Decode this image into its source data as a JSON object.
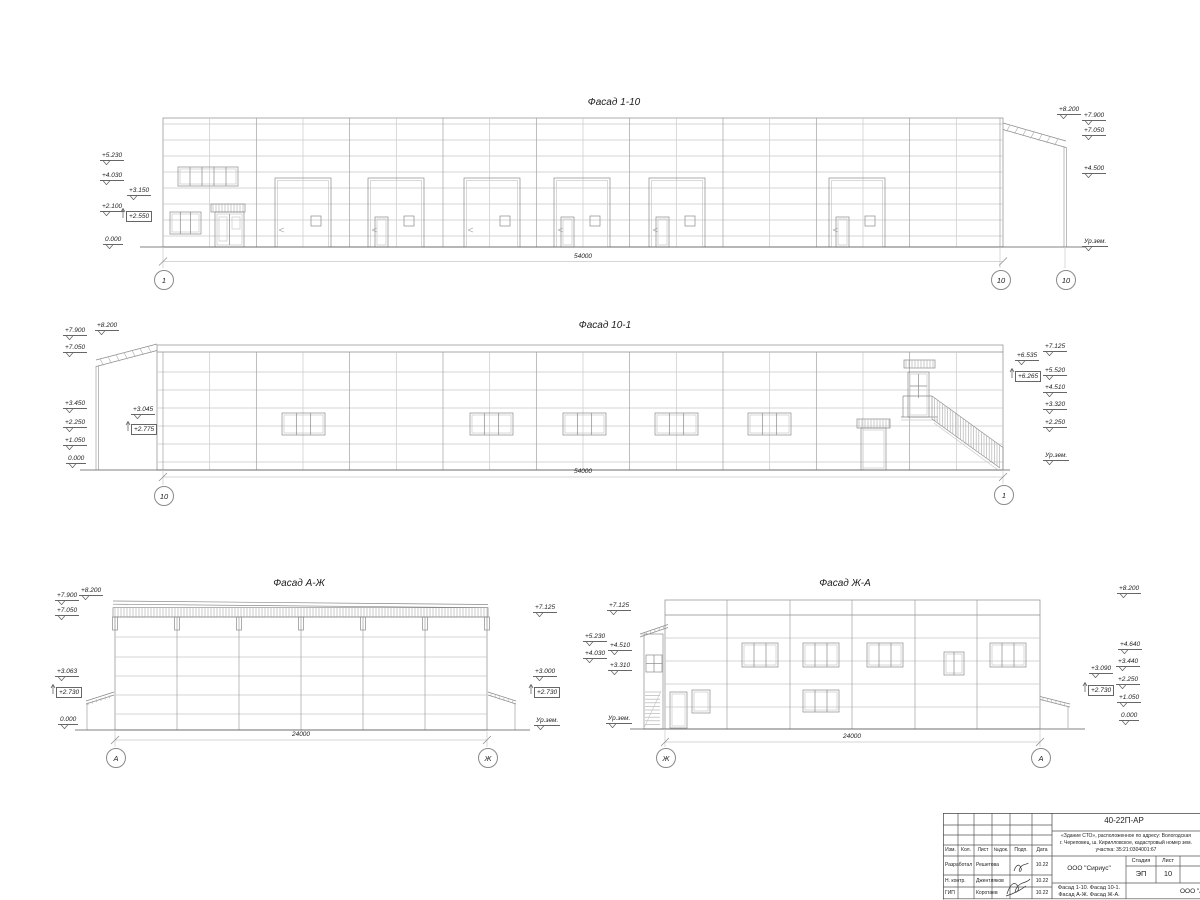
{
  "palette": {
    "line": "#8a8a8a",
    "panel": "#c9c9c9",
    "ground": "#5a5a5a",
    "text": "#222222",
    "paper": "#ffffff"
  },
  "titles": {
    "f110": "Фасад 1-10",
    "f101": "Фасад 10-1",
    "faj": "Фасад А-Ж",
    "fja": "Фасад Ж-А"
  },
  "dims": [
    {
      "label": "54000",
      "x": 583,
      "y": 253
    },
    {
      "label": "54000",
      "x": 583,
      "y": 468
    },
    {
      "label": "24000",
      "x": 301,
      "y": 731
    },
    {
      "label": "24000",
      "x": 852,
      "y": 733
    }
  ],
  "axes": [
    {
      "label": "1",
      "x": 163,
      "y": 279
    },
    {
      "label": "10",
      "x": 1000,
      "y": 279
    },
    {
      "label": "10",
      "x": 1065,
      "y": 279
    },
    {
      "label": "10",
      "x": 163,
      "y": 495
    },
    {
      "label": "1",
      "x": 1003,
      "y": 494
    },
    {
      "label": "А",
      "x": 115,
      "y": 757
    },
    {
      "label": "Ж",
      "x": 487,
      "y": 757
    },
    {
      "label": "Ж",
      "x": 665,
      "y": 757
    },
    {
      "label": "А",
      "x": 1040,
      "y": 757
    }
  ],
  "marks": [
    {
      "v": "+5.230",
      "x": 100,
      "y": 152
    },
    {
      "v": "+4.030",
      "x": 100,
      "y": 172
    },
    {
      "v": "+3.150",
      "x": 127,
      "y": 187
    },
    {
      "v": "+2.100",
      "x": 100,
      "y": 203
    },
    {
      "v": "+2.550",
      "x": 126,
      "y": 211,
      "boxed": true
    },
    {
      "v": "0.000",
      "x": 103,
      "y": 236
    },
    {
      "v": "+8.200",
      "x": 1057,
      "y": 106
    },
    {
      "v": "+7.900",
      "x": 1082,
      "y": 112
    },
    {
      "v": "+7.050",
      "x": 1082,
      "y": 127
    },
    {
      "v": "+4.500",
      "x": 1082,
      "y": 165
    },
    {
      "v": "Ур.зем.",
      "x": 1082,
      "y": 238
    },
    {
      "v": "+7.900",
      "x": 63,
      "y": 327
    },
    {
      "v": "+8.200",
      "x": 95,
      "y": 322
    },
    {
      "v": "+7.050",
      "x": 63,
      "y": 344
    },
    {
      "v": "+3.450",
      "x": 63,
      "y": 400
    },
    {
      "v": "+3.045",
      "x": 131,
      "y": 406
    },
    {
      "v": "+2.250",
      "x": 63,
      "y": 419
    },
    {
      "v": "+2.775",
      "x": 131,
      "y": 424,
      "boxed": true
    },
    {
      "v": "+1.050",
      "x": 63,
      "y": 437
    },
    {
      "v": "0.000",
      "x": 66,
      "y": 455
    },
    {
      "v": "+7.125",
      "x": 1043,
      "y": 343
    },
    {
      "v": "+6.535",
      "x": 1015,
      "y": 352
    },
    {
      "v": "+6.265",
      "x": 1015,
      "y": 371,
      "boxed": true
    },
    {
      "v": "+5.520",
      "x": 1043,
      "y": 367
    },
    {
      "v": "+4.510",
      "x": 1043,
      "y": 384
    },
    {
      "v": "+3.320",
      "x": 1043,
      "y": 401
    },
    {
      "v": "+2.250",
      "x": 1043,
      "y": 419
    },
    {
      "v": "Ур.зем.",
      "x": 1043,
      "y": 452
    },
    {
      "v": "+7.900",
      "x": 55,
      "y": 592
    },
    {
      "v": "+8.200",
      "x": 79,
      "y": 587
    },
    {
      "v": "+7.050",
      "x": 55,
      "y": 607
    },
    {
      "v": "+3.063",
      "x": 55,
      "y": 668
    },
    {
      "v": "+2.730",
      "x": 56,
      "y": 687,
      "boxed": true
    },
    {
      "v": "0.000",
      "x": 58,
      "y": 716
    },
    {
      "v": "+7.125",
      "x": 533,
      "y": 604
    },
    {
      "v": "+3.000",
      "x": 533,
      "y": 668
    },
    {
      "v": "+2.730",
      "x": 534,
      "y": 687,
      "boxed": true
    },
    {
      "v": "Ур.зем.",
      "x": 534,
      "y": 717
    },
    {
      "v": "+7.125",
      "x": 607,
      "y": 602
    },
    {
      "v": "+5.230",
      "x": 583,
      "y": 633
    },
    {
      "v": "+4.510",
      "x": 608,
      "y": 642
    },
    {
      "v": "+4.030",
      "x": 583,
      "y": 650
    },
    {
      "v": "+3.310",
      "x": 608,
      "y": 662
    },
    {
      "v": "Ур.зем.",
      "x": 606,
      "y": 715
    },
    {
      "v": "+8.200",
      "x": 1117,
      "y": 585
    },
    {
      "v": "+4.640",
      "x": 1118,
      "y": 641
    },
    {
      "v": "+3.440",
      "x": 1116,
      "y": 658
    },
    {
      "v": "+3.090",
      "x": 1089,
      "y": 665
    },
    {
      "v": "+2.250",
      "x": 1116,
      "y": 676
    },
    {
      "v": "+2.730",
      "x": 1088,
      "y": 685,
      "boxed": true
    },
    {
      "v": "+1.050",
      "x": 1117,
      "y": 694
    },
    {
      "v": "0.000",
      "x": 1119,
      "y": 712
    }
  ],
  "titleblock": {
    "code": "40-22П-АР",
    "desc_lines": [
      "«Здание СТО», расположенное по адресу: Вологодская",
      "г. Череповец, ш. Кирилловское, кадастровый номер зем.",
      "участка: 35:21:0304001:67"
    ],
    "header_cols": [
      "Изм.",
      "Кол.",
      "Лист",
      "№док.",
      "Подп.",
      "Дата"
    ],
    "rows": [
      {
        "role": "Разработал",
        "name": "Решетова",
        "date": "10.22"
      },
      {
        "role": "Н. контр.",
        "name": "Джентляков",
        "date": "10.22"
      },
      {
        "role": "ГИП",
        "name": "Коротаев",
        "date": "10.22"
      }
    ],
    "org": "ООО \"Сириус\"",
    "sheet_title_lines": [
      "Фасад 1-10. Фасад 10-1.",
      "Фасад А-Ж. Фасад Ж-А."
    ],
    "stage_label": "Стадия",
    "sheet_label": "Лист",
    "stage": "ЭП",
    "sheet_no": "10",
    "org2": "ООО \"Ар"
  }
}
